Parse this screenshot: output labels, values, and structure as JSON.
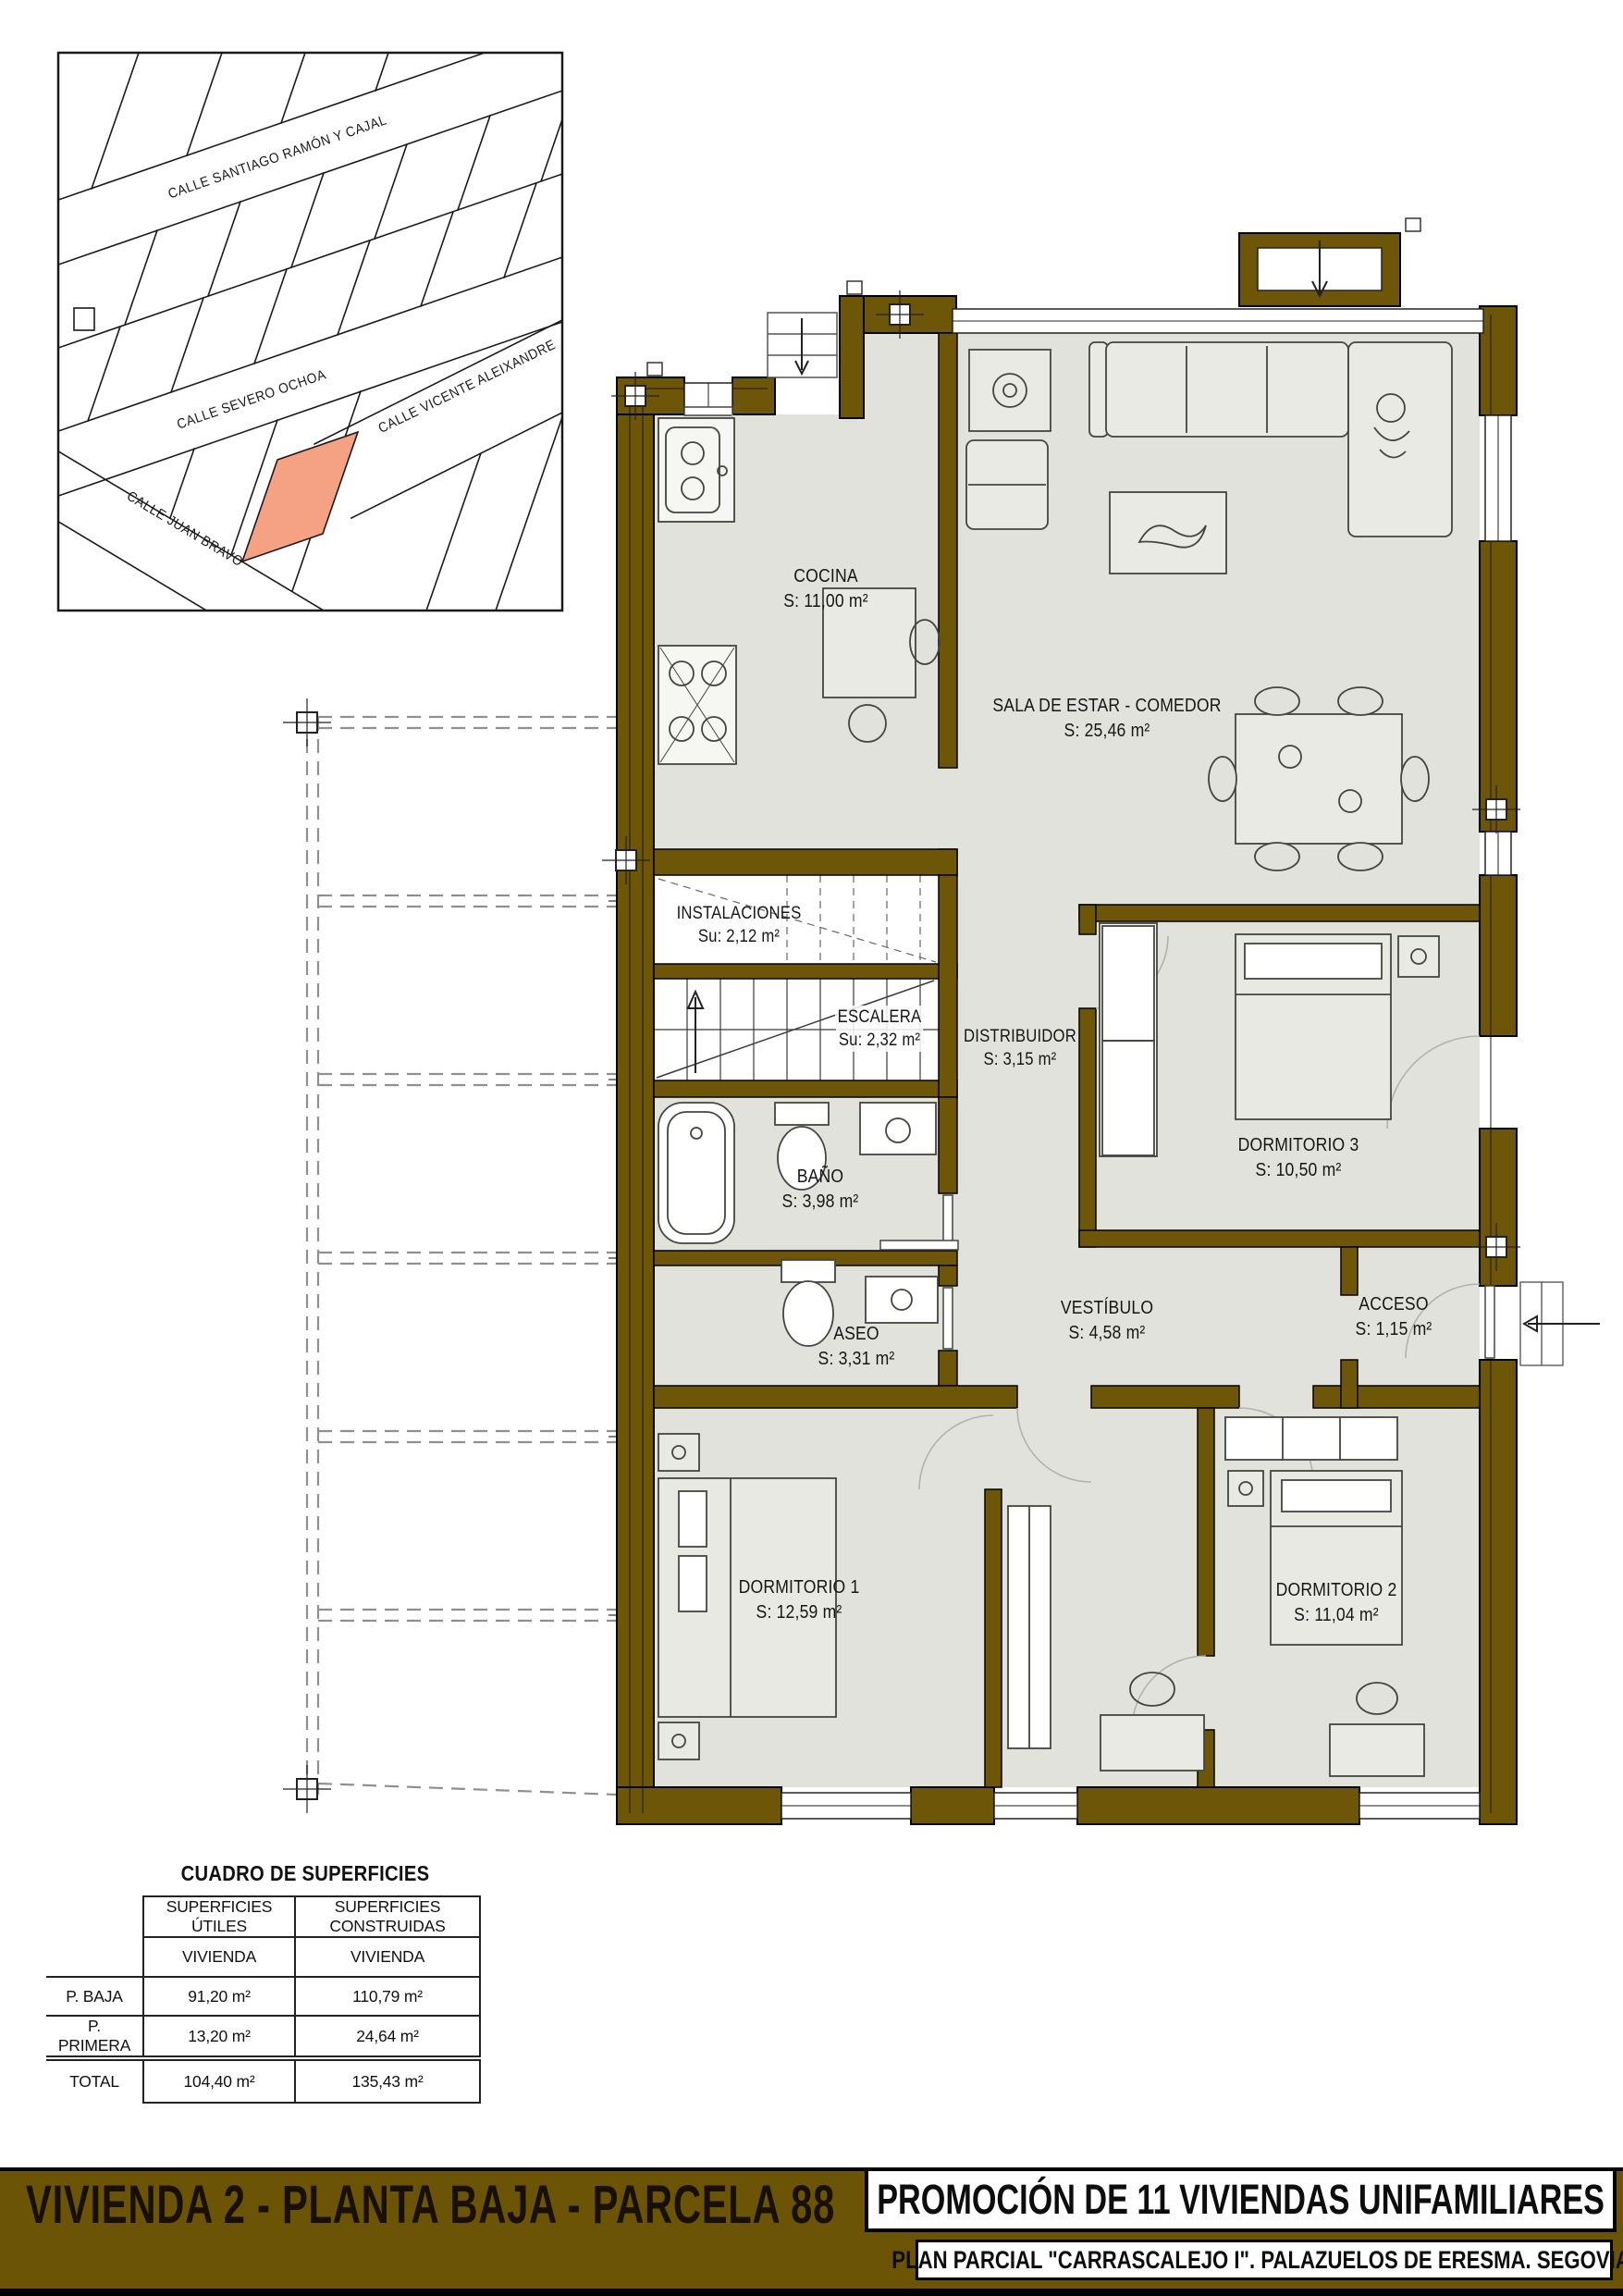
{
  "site_map": {
    "streets": [
      {
        "label": "CALLE SANTIAGO RAMÓN Y CAJAL"
      },
      {
        "label": "CALLE SEVERO OCHOA"
      },
      {
        "label": "CALLE VICENTE  ALEIXANDRE"
      },
      {
        "label": "CALLE JUAN BRAVO"
      }
    ],
    "highlight_color": "#f5a183"
  },
  "plan": {
    "wall_color": "#6e5608",
    "floor_color": "#e2e2dc",
    "rooms": [
      {
        "name": "COCINA",
        "area": "S: 11,00 m²"
      },
      {
        "name": "SALA DE ESTAR - COMEDOR",
        "area": "S: 25,46 m²"
      },
      {
        "name": "INSTALACIONES",
        "area": "Su: 2,12 m²"
      },
      {
        "name": "ESCALERA",
        "area": "Su: 2,32 m²"
      },
      {
        "name": "DISTRIBUIDOR",
        "area": "S: 3,15 m²"
      },
      {
        "name": "DORMITORIO 3",
        "area": "S: 10,50 m²"
      },
      {
        "name": "BAÑO",
        "area": "S: 3,98 m²"
      },
      {
        "name": "ASEO",
        "area": "S: 3,31 m²"
      },
      {
        "name": "VESTÍBULO",
        "area": "S: 4,58 m²"
      },
      {
        "name": "ACCESO",
        "area": "S: 1,15 m²"
      },
      {
        "name": "DORMITORIO 1",
        "area": "S: 12,59 m²"
      },
      {
        "name": "DORMITORIO 2",
        "area": "S: 11,04 m²"
      }
    ]
  },
  "surface_table": {
    "title": "CUADRO DE SUPERFICIES",
    "col_headers": [
      "SUPERFICIES ÚTILES",
      "SUPERFICIES CONSTRUIDAS"
    ],
    "sub_headers": [
      "VIVIENDA",
      "VIVIENDA"
    ],
    "rows": [
      {
        "label": "P. BAJA",
        "util": "91,20 m²",
        "construida": "110,79 m²"
      },
      {
        "label": "P. PRIMERA",
        "util": "13,20 m²",
        "construida": "24,64 m²"
      }
    ],
    "total": {
      "label": "TOTAL",
      "util": "104,40 m²",
      "construida": "135,43 m²"
    }
  },
  "footer": {
    "left_title": "VIVIENDA 2 - PLANTA BAJA - PARCELA 88",
    "right_title": "PROMOCIÓN DE 11 VIVIENDAS UNIFAMILIARES",
    "right_subtitle": "PLAN PARCIAL \"CARRASCALEJO I\". PALAZUELOS DE ERESMA. SEGOVIA.",
    "bar_color": "#6b5405"
  }
}
